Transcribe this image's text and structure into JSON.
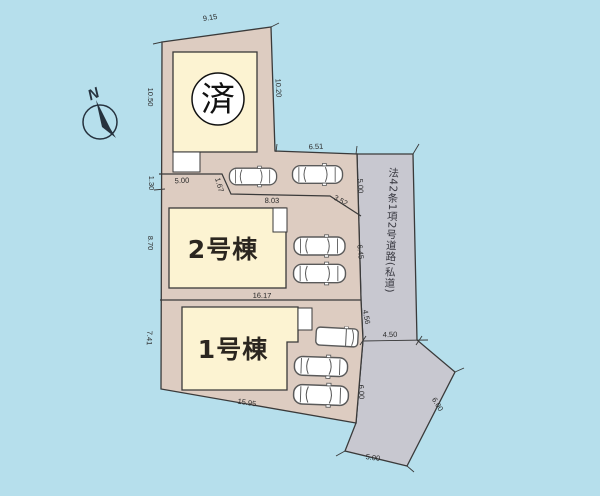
{
  "site": {
    "sold_label": "済",
    "building2_label": "2号棟",
    "building1_label": "1号棟",
    "road_label": "法42条1項2号道路(私道)",
    "compass_label": "N"
  },
  "colors": {
    "background": "#b6dfec",
    "plot": "#ddccc1",
    "building": "#fcf3d2",
    "road": "#c8c8d0",
    "line": "#3a3a3a"
  },
  "dimensions": {
    "top_width": "9.15",
    "left_upper": "10.50",
    "right_upper": "10.20",
    "north_strip_width": "6.51",
    "sold_plot_south": "5.00",
    "left_step": "1.30",
    "step_diagonal": "1.67",
    "plot2_north": "8.03",
    "plot2_north_diagonal": "3.52",
    "road_upper": "5.00",
    "left_plot2": "8.70",
    "road_middle": "6.45",
    "plot2_south": "16.17",
    "left_plot1": "7.41",
    "road_lower": "4.56",
    "road_width": "4.50",
    "road_left_lower": "6.00",
    "road_right_diagonal": "6.00",
    "plot1_south": "15.95",
    "road_bottom": "5.00"
  }
}
